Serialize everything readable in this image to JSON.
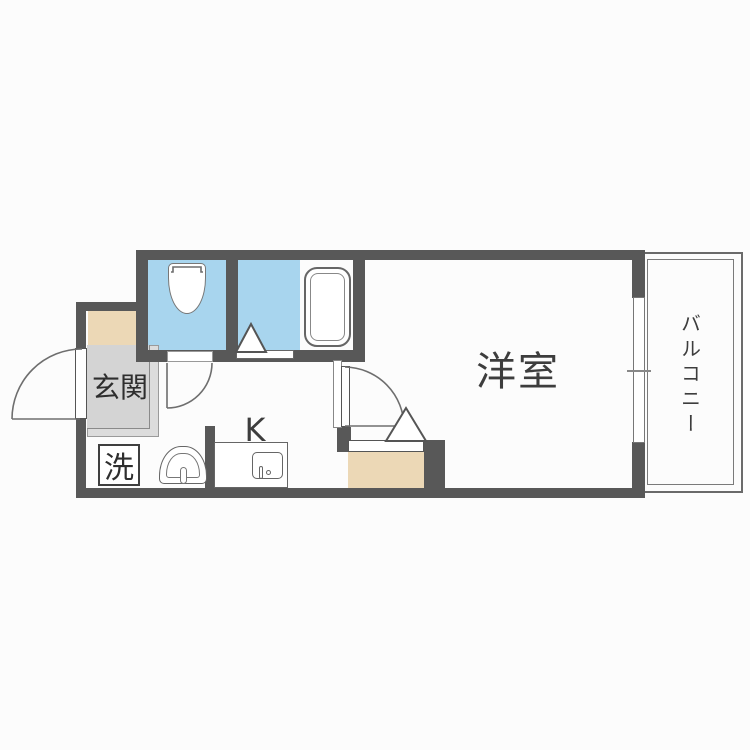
{
  "floorplan": {
    "title": "1K apartment floor plan",
    "rooms": {
      "entrance": {
        "label": "玄関"
      },
      "laundry": {
        "label": "洗"
      },
      "kitchen": {
        "label": "K"
      },
      "western_room": {
        "label": "洋室"
      },
      "balcony": {
        "label": "バルコニー"
      }
    },
    "fixtures": [
      "toilet",
      "bathtub",
      "kitchen-sink",
      "washbasin-dome",
      "front-door",
      "interior-doors",
      "closet",
      "sliding-window"
    ],
    "colors": {
      "wall": "#585858",
      "wet_floor": "#a8d5ee",
      "step_beige": "#ecd8b6",
      "entrance_gray": "#d4d4d4",
      "fixture_outline": "#6e6e6e",
      "label_text": "#2e2e2e"
    }
  }
}
